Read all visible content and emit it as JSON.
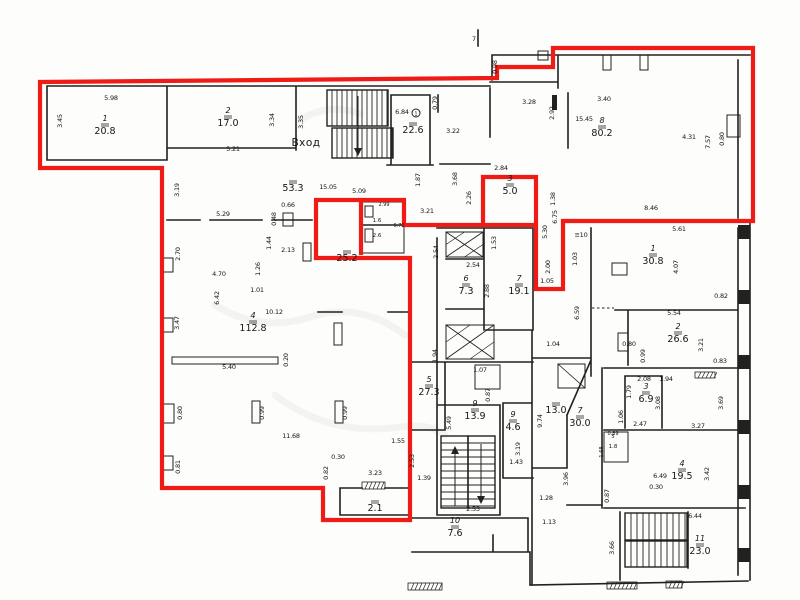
{
  "palette": {
    "outline_red": "#ee1b17",
    "wall_black": "#21211e",
    "paper": "#fdfdfb"
  },
  "entrance": {
    "label": "Вход",
    "x": 306,
    "y": 146
  },
  "unit_outline": {
    "color": "#ee1b17",
    "points": [
      [
        40,
        82
      ],
      [
        497,
        78
      ],
      [
        497,
        67
      ],
      [
        553,
        67
      ],
      [
        553,
        48
      ],
      [
        753,
        48
      ],
      [
        753,
        221
      ],
      [
        563,
        221
      ],
      [
        563,
        289
      ],
      [
        536,
        289
      ],
      [
        536,
        177
      ],
      [
        483,
        177
      ],
      [
        483,
        225
      ],
      [
        404,
        225
      ],
      [
        404,
        200
      ],
      [
        316,
        200
      ],
      [
        316,
        258
      ],
      [
        410,
        258
      ],
      [
        410,
        520
      ],
      [
        323,
        520
      ],
      [
        323,
        488
      ],
      [
        162,
        488
      ],
      [
        162,
        168
      ],
      [
        40,
        168
      ]
    ],
    "extra_segments": [
      [
        483,
        225,
        536,
        225
      ],
      [
        361,
        200,
        361,
        255
      ]
    ]
  },
  "rooms": [
    {
      "number": "1",
      "area": "20.8",
      "x": 105,
      "y": 125
    },
    {
      "number": "2",
      "area": "17.0",
      "x": 228,
      "y": 117
    },
    {
      "number": "",
      "area": "53.3",
      "x": 293,
      "y": 182
    },
    {
      "number": "",
      "area": "22.6",
      "x": 413,
      "y": 124
    },
    {
      "number": "3",
      "area": "5.0",
      "x": 510,
      "y": 185
    },
    {
      "number": "8",
      "area": "80.2",
      "x": 602,
      "y": 127
    },
    {
      "number": "",
      "area": "25.2",
      "x": 347,
      "y": 252
    },
    {
      "number": "4",
      "area": "112.8",
      "x": 253,
      "y": 322
    },
    {
      "number": "6",
      "area": "7.3",
      "x": 466,
      "y": 285
    },
    {
      "number": "7",
      "area": "19.1",
      "x": 519,
      "y": 285
    },
    {
      "number": "1",
      "area": "30.8",
      "x": 653,
      "y": 255
    },
    {
      "number": "2",
      "area": "26.6",
      "x": 678,
      "y": 333
    },
    {
      "number": "3",
      "area": "6.9",
      "x": 646,
      "y": 393
    },
    {
      "number": "5",
      "area": "27.3",
      "x": 429,
      "y": 386
    },
    {
      "number": "9",
      "area": "13.9",
      "x": 475,
      "y": 410
    },
    {
      "number": "9",
      "area": "4.6",
      "x": 513,
      "y": 421
    },
    {
      "number": "",
      "area": "13.0",
      "x": 556,
      "y": 404
    },
    {
      "number": "7",
      "area": "30.0",
      "x": 580,
      "y": 417
    },
    {
      "number": "10",
      "area": "7.6",
      "x": 455,
      "y": 527
    },
    {
      "number": "",
      "area": "2.1",
      "x": 375,
      "y": 502
    },
    {
      "number": "4",
      "area": "19.5",
      "x": 682,
      "y": 470
    },
    {
      "number": "11",
      "area": "23.0",
      "x": 700,
      "y": 545
    },
    {
      "number": "5",
      "area": "1.8",
      "x": 613,
      "y": 442,
      "small": true
    },
    {
      "number": "",
      "area": "1.6",
      "x": 377,
      "y": 216,
      "small": true
    },
    {
      "number": "",
      "area": "2.6",
      "x": 377,
      "y": 231,
      "small": true
    }
  ],
  "dimensions": [
    {
      "t": "5.98",
      "x": 111,
      "y": 100
    },
    {
      "t": "3.45",
      "x": 62,
      "y": 121,
      "r": 90
    },
    {
      "t": "3.34",
      "x": 274,
      "y": 120,
      "r": 90
    },
    {
      "t": "3.35",
      "x": 303,
      "y": 122,
      "r": 90
    },
    {
      "t": "5.21",
      "x": 233,
      "y": 151
    },
    {
      "t": "3.19",
      "x": 179,
      "y": 190,
      "r": 90
    },
    {
      "t": "5.29",
      "x": 223,
      "y": 216
    },
    {
      "t": "15.05",
      "x": 328,
      "y": 189
    },
    {
      "t": "5.09",
      "x": 359,
      "y": 193
    },
    {
      "t": "0.66",
      "x": 288,
      "y": 207
    },
    {
      "t": "0.48",
      "x": 276,
      "y": 219,
      "r": 90
    },
    {
      "t": "6.84",
      "x": 402,
      "y": 114
    },
    {
      "t": "0.79",
      "x": 437,
      "y": 103,
      "r": 90
    },
    {
      "t": "3.22",
      "x": 453,
      "y": 133
    },
    {
      "t": "1.87",
      "x": 420,
      "y": 180,
      "r": 90
    },
    {
      "t": "3.68",
      "x": 457,
      "y": 179,
      "r": 90
    },
    {
      "t": "2.26",
      "x": 471,
      "y": 198,
      "r": 90
    },
    {
      "t": "3.21",
      "x": 427,
      "y": 213
    },
    {
      "t": "2.84",
      "x": 501,
      "y": 170
    },
    {
      "t": "3.28",
      "x": 529,
      "y": 104
    },
    {
      "t": "2.92",
      "x": 554,
      "y": 113,
      "r": 90
    },
    {
      "t": "15.45",
      "x": 584,
      "y": 121
    },
    {
      "t": "3.40",
      "x": 604,
      "y": 101
    },
    {
      "t": "4.31",
      "x": 689,
      "y": 139
    },
    {
      "t": "7.57",
      "x": 710,
      "y": 142,
      "r": 90
    },
    {
      "t": "0.80",
      "x": 724,
      "y": 139,
      "r": 90
    },
    {
      "t": "8.46",
      "x": 651,
      "y": 210
    },
    {
      "t": "0.98",
      "x": 497,
      "y": 67,
      "r": 90
    },
    {
      "t": "1.38",
      "x": 555,
      "y": 199,
      "r": 90
    },
    {
      "t": "6.75",
      "x": 557,
      "y": 217,
      "r": 90
    },
    {
      "t": "5.30",
      "x": 547,
      "y": 232,
      "r": 90
    },
    {
      "t": "2.00",
      "x": 550,
      "y": 267,
      "r": 90
    },
    {
      "t": "1.05",
      "x": 547,
      "y": 283
    },
    {
      "t": "2.99",
      "x": 384,
      "y": 206,
      "s": 1
    },
    {
      "t": "6.70",
      "x": 399,
      "y": 227,
      "s": 1
    },
    {
      "t": "1.44",
      "x": 271,
      "y": 243,
      "r": 90
    },
    {
      "t": "2.13",
      "x": 288,
      "y": 252
    },
    {
      "t": "1.26",
      "x": 260,
      "y": 269,
      "r": 90
    },
    {
      "t": "1.01",
      "x": 257,
      "y": 292
    },
    {
      "t": "2.70",
      "x": 180,
      "y": 254,
      "r": 90
    },
    {
      "t": "4.70",
      "x": 219,
      "y": 276
    },
    {
      "t": "6.42",
      "x": 219,
      "y": 298,
      "r": 90
    },
    {
      "t": "3.47",
      "x": 179,
      "y": 323,
      "r": 90
    },
    {
      "t": "10.12",
      "x": 274,
      "y": 314
    },
    {
      "t": "5.40",
      "x": 229,
      "y": 369
    },
    {
      "t": "0.20",
      "x": 288,
      "y": 360,
      "r": 90
    },
    {
      "t": "0.80",
      "x": 182,
      "y": 413,
      "r": 90
    },
    {
      "t": "0.99",
      "x": 264,
      "y": 413,
      "r": 90
    },
    {
      "t": "0.99",
      "x": 347,
      "y": 413,
      "r": 90
    },
    {
      "t": "11.68",
      "x": 291,
      "y": 438
    },
    {
      "t": "0.81",
      "x": 180,
      "y": 467,
      "r": 90
    },
    {
      "t": "0.30",
      "x": 338,
      "y": 459
    },
    {
      "t": "0.82",
      "x": 328,
      "y": 473,
      "r": 90
    },
    {
      "t": "3.23",
      "x": 375,
      "y": 475
    },
    {
      "t": "1.55",
      "x": 398,
      "y": 443
    },
    {
      "t": "2.53",
      "x": 414,
      "y": 461,
      "r": 90
    },
    {
      "t": "1.39",
      "x": 424,
      "y": 480
    },
    {
      "t": "2.54",
      "x": 438,
      "y": 252,
      "r": 90
    },
    {
      "t": "2.54",
      "x": 473,
      "y": 267
    },
    {
      "t": "1.53",
      "x": 496,
      "y": 243,
      "r": 90
    },
    {
      "t": "2.88",
      "x": 489,
      "y": 291,
      "r": 90
    },
    {
      "t": "1.03",
      "x": 577,
      "y": 259,
      "r": 90
    },
    {
      "t": "6.59",
      "x": 579,
      "y": 313,
      "r": 90
    },
    {
      "t": "1.04",
      "x": 553,
      "y": 346
    },
    {
      "t": "1.94",
      "x": 437,
      "y": 356,
      "r": 90
    },
    {
      "t": "1.07",
      "x": 480,
      "y": 372
    },
    {
      "t": "0.87",
      "x": 490,
      "y": 395,
      "r": 90
    },
    {
      "t": "≡10",
      "x": 581,
      "y": 237
    },
    {
      "t": "5.61",
      "x": 679,
      "y": 231
    },
    {
      "t": "4.07",
      "x": 678,
      "y": 267,
      "r": 90
    },
    {
      "t": "0.82",
      "x": 721,
      "y": 298
    },
    {
      "t": "5.54",
      "x": 674,
      "y": 315
    },
    {
      "t": "0.80",
      "x": 629,
      "y": 346
    },
    {
      "t": "0.99",
      "x": 645,
      "y": 356,
      "r": 90
    },
    {
      "t": "3.21",
      "x": 703,
      "y": 345,
      "r": 90
    },
    {
      "t": "0.83",
      "x": 720,
      "y": 363
    },
    {
      "t": "1.94",
      "x": 666,
      "y": 381
    },
    {
      "t": "2.08",
      "x": 644,
      "y": 381
    },
    {
      "t": "1.79",
      "x": 631,
      "y": 392,
      "r": 90
    },
    {
      "t": "3.08",
      "x": 660,
      "y": 403,
      "r": 90
    },
    {
      "t": "1.06",
      "x": 623,
      "y": 417,
      "r": 90
    },
    {
      "t": "2.47",
      "x": 640,
      "y": 426
    },
    {
      "t": "3.27",
      "x": 698,
      "y": 428
    },
    {
      "t": "3.69",
      "x": 723,
      "y": 403,
      "r": 90
    },
    {
      "t": "0.89",
      "x": 613,
      "y": 435,
      "s": 1
    },
    {
      "t": "1.68",
      "x": 603,
      "y": 452,
      "r": 90,
      "s": 1
    },
    {
      "t": "6.49",
      "x": 660,
      "y": 478
    },
    {
      "t": "0.30",
      "x": 656,
      "y": 489
    },
    {
      "t": "3.42",
      "x": 709,
      "y": 474,
      "r": 90
    },
    {
      "t": "0.87",
      "x": 609,
      "y": 496,
      "r": 90
    },
    {
      "t": "6.44",
      "x": 695,
      "y": 518
    },
    {
      "t": "3.66",
      "x": 614,
      "y": 548,
      "r": 90
    },
    {
      "t": "5.49",
      "x": 451,
      "y": 423,
      "r": 90
    },
    {
      "t": "2.53",
      "x": 473,
      "y": 511
    },
    {
      "t": "9.74",
      "x": 542,
      "y": 421,
      "r": 90
    },
    {
      "t": "3.19",
      "x": 520,
      "y": 449,
      "r": 90
    },
    {
      "t": "1.43",
      "x": 516,
      "y": 464
    },
    {
      "t": "3.96",
      "x": 568,
      "y": 479,
      "r": 90
    },
    {
      "t": "1.28",
      "x": 546,
      "y": 500
    },
    {
      "t": "1.13",
      "x": 549,
      "y": 524
    },
    {
      "t": "7",
      "x": 474,
      "y": 41
    }
  ]
}
